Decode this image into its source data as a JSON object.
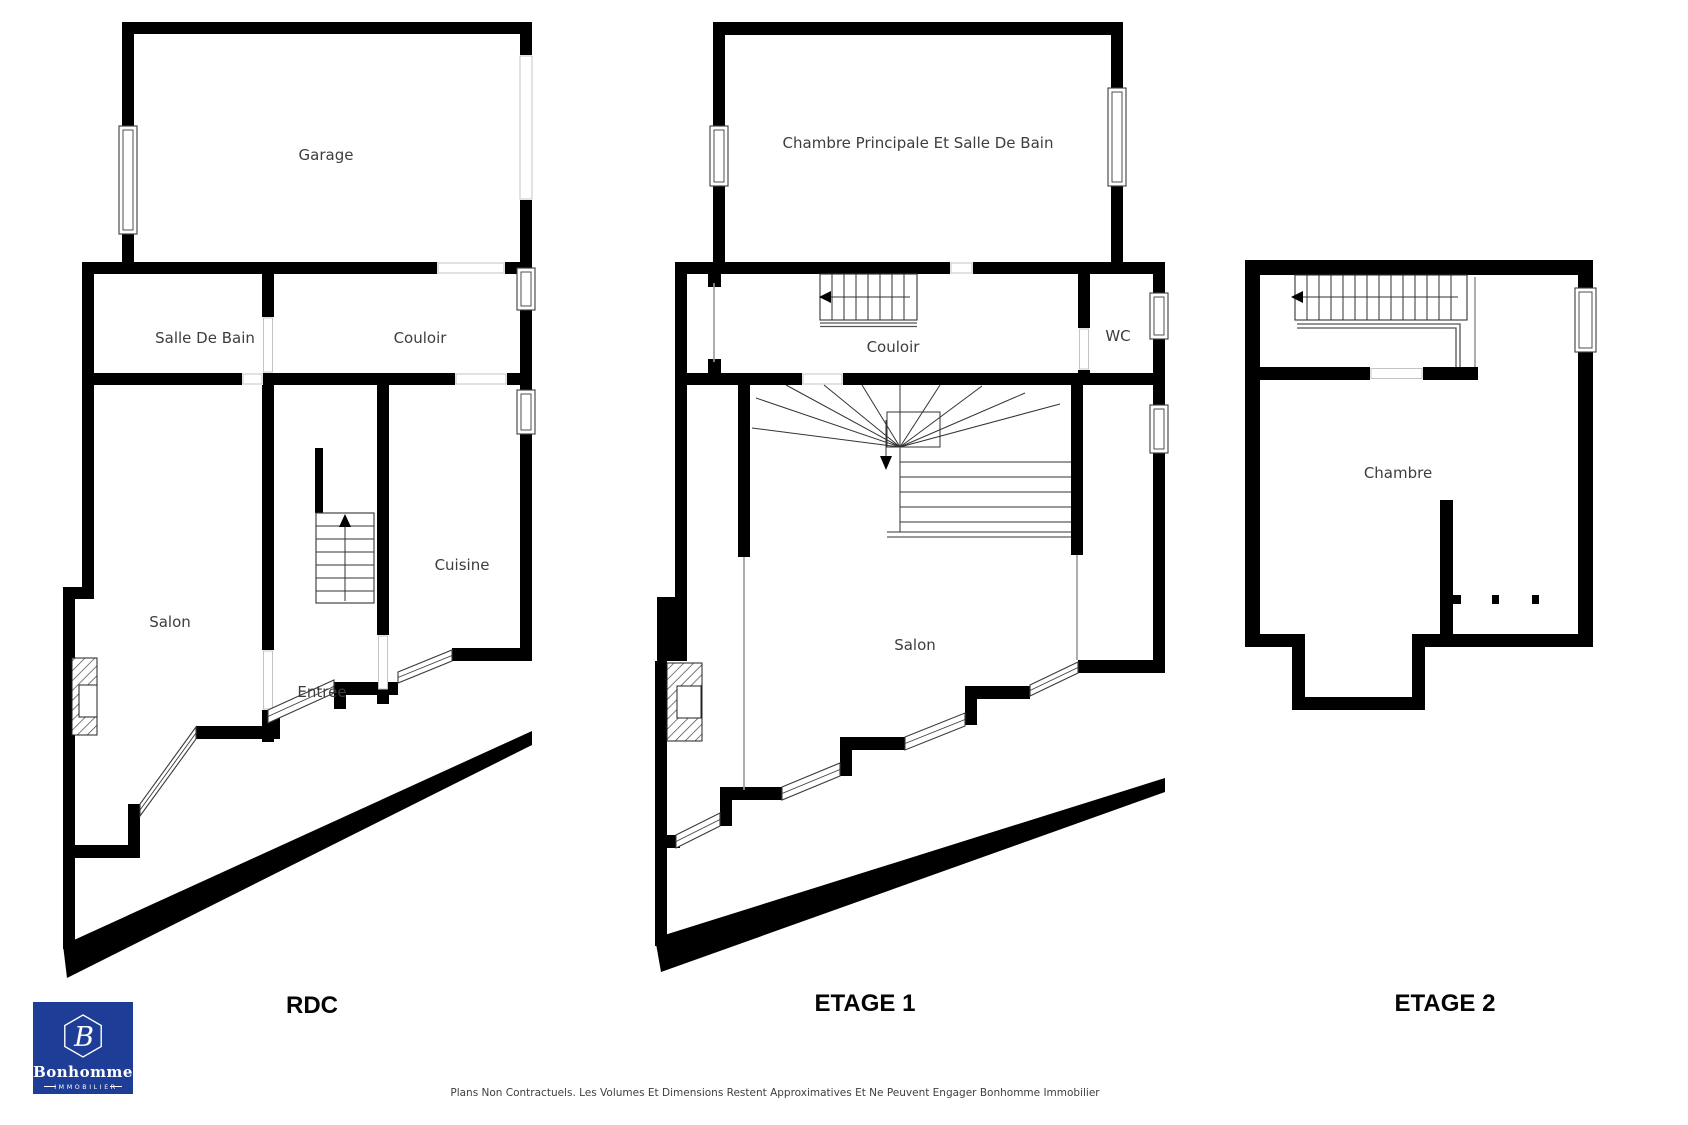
{
  "page": {
    "background": "#ffffff",
    "type": "floor-plan-sheet"
  },
  "floors": {
    "rdc": {
      "label": "RDC",
      "rooms": {
        "garage": "Garage",
        "salle_de_bain": "Salle De Bain",
        "couloir": "Couloir",
        "salon": "Salon",
        "entree": "Entrée",
        "cuisine": "Cuisine"
      }
    },
    "etage1": {
      "label": "ETAGE 1",
      "rooms": {
        "chambre_principale": "Chambre Principale Et Salle De Bain",
        "couloir": "Couloir",
        "wc": "WC",
        "salon": "Salon"
      }
    },
    "etage2": {
      "label": "ETAGE 2",
      "rooms": {
        "chambre": "Chambre"
      }
    }
  },
  "logo": {
    "monogram": "B",
    "brand": "Bonhomme",
    "subtitle": "IMMOBILIER",
    "background_color": "#1e3d96",
    "text_color": "#ffffff"
  },
  "footer": {
    "disclaimer": "Plans Non Contractuels. Les Volumes Et Dimensions Restent Approximatives Et Ne Peuvent Engager Bonhomme Immobilier"
  },
  "colors": {
    "wall": "#000000",
    "room_label": "#3d3d3d",
    "floor_label": "#000000"
  }
}
